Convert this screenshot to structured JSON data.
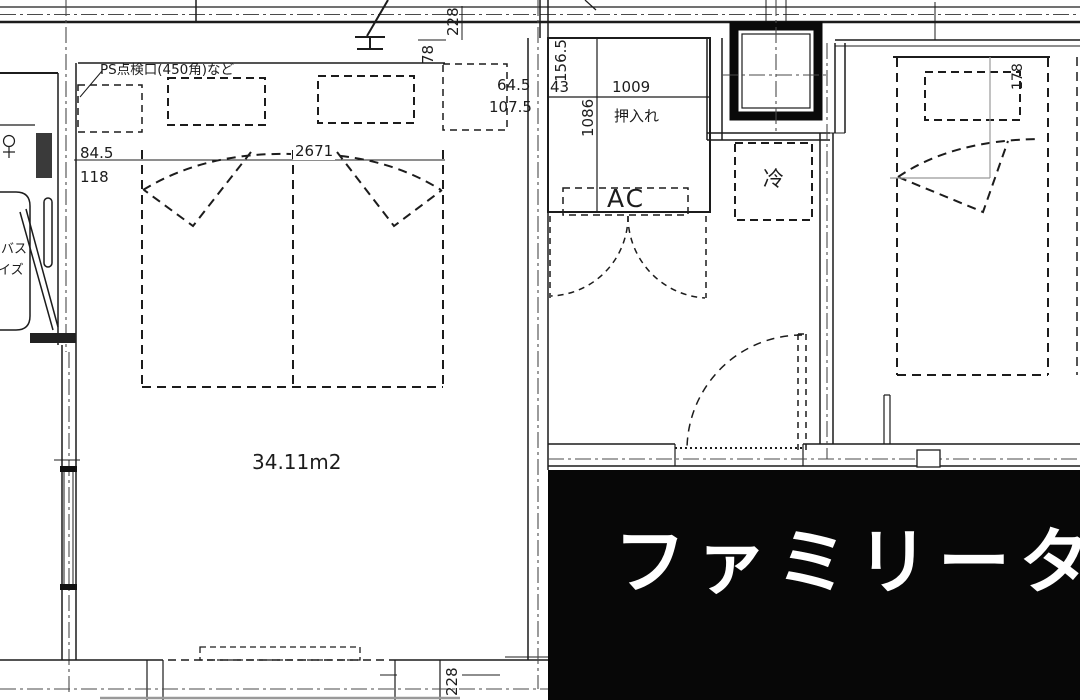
{
  "title_banner": {
    "text": "ファミリータ",
    "bg_color": "#070707",
    "text_color": "#ffffff"
  },
  "labels": {
    "ps_note": "PS点検口(450角)など",
    "room_area": "34.11m2",
    "closet": "押入れ",
    "ac_unit": "AC",
    "fridge": "冷",
    "bath_line1": "バス",
    "bath_line2": "イズ"
  },
  "dimensions": {
    "top_228": "228",
    "top_78": "78",
    "left_84_5": "84.5",
    "left_118": "118",
    "bed_width_2671": "2671",
    "right_64_5": "64.5",
    "right_107_5": "107.5",
    "closet_156_5": "156.5",
    "closet_43": "43",
    "closet_1009": "1009",
    "closet_1086": "1086",
    "right_bed_178": "178",
    "bottom_228": "228"
  },
  "colors": {
    "line": "#1c1c1c",
    "centerline": "#4a4a4a",
    "light_line": "#999999"
  }
}
